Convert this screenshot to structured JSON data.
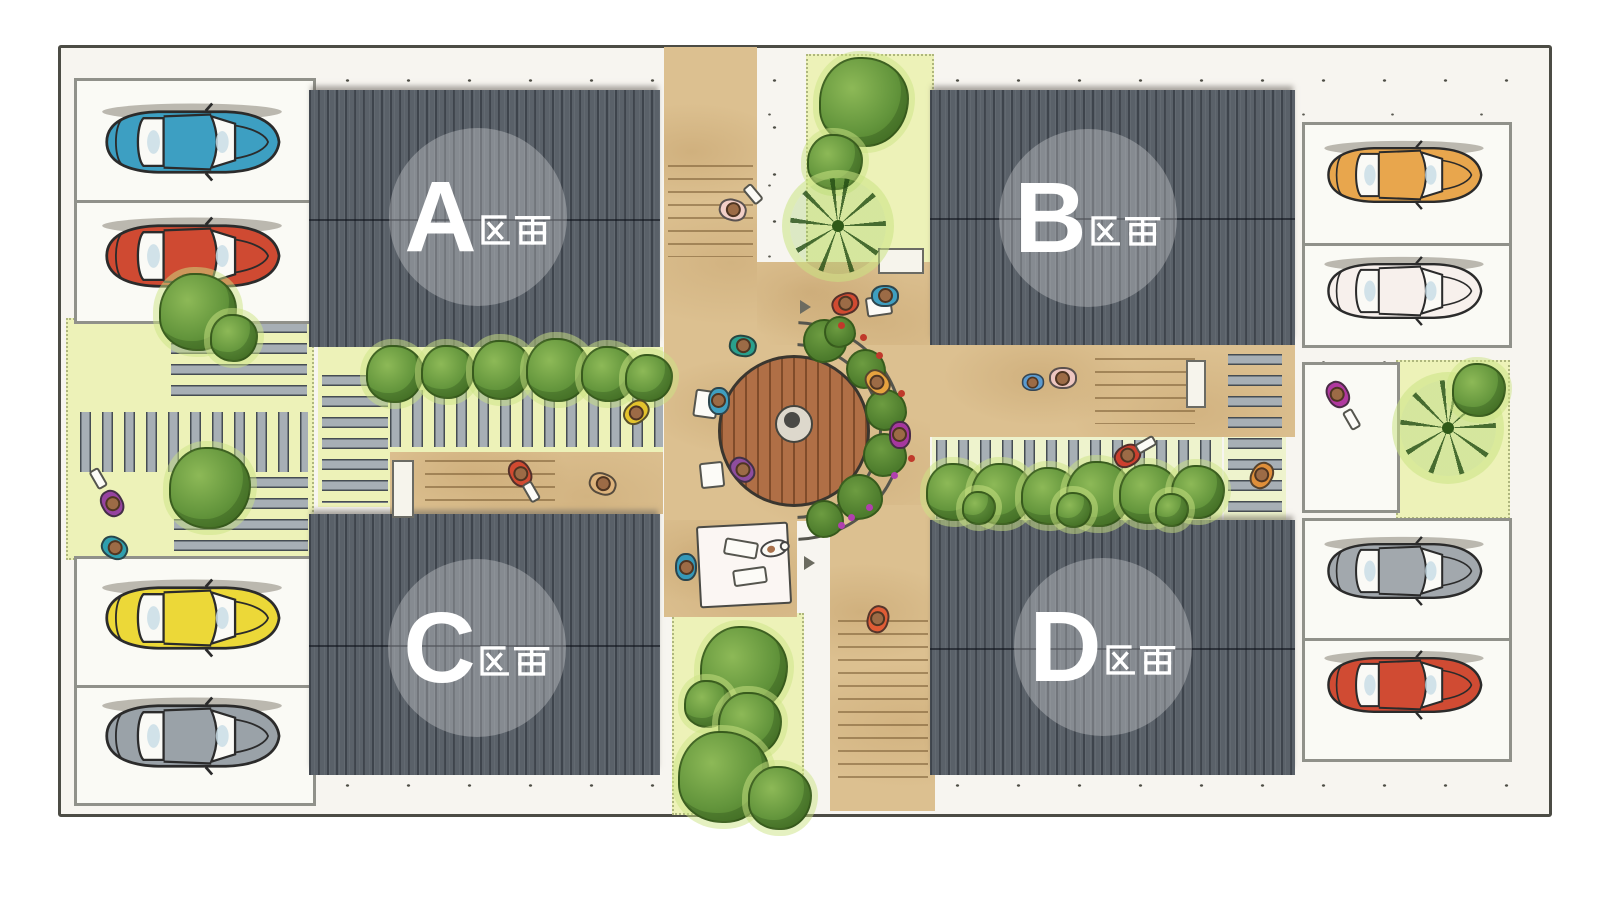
{
  "plan": {
    "title": "housing site plan",
    "plots": [
      {
        "letter": "A",
        "suffix": "区画"
      },
      {
        "letter": "B",
        "suffix": "区画"
      },
      {
        "letter": "C",
        "suffix": "区画"
      },
      {
        "letter": "D",
        "suffix": "区画"
      }
    ],
    "colors": {
      "roof": "#5a6169",
      "roof_ridge": "#343a43",
      "path_tan": "#dcc090",
      "grass": "#edf2b8",
      "stone": "#a7afb5",
      "stall_bg": "#fafaf5",
      "stall_border": "#90918a",
      "frame_bg": "#f7f5f0",
      "frame_border": "#4c4c45",
      "table_wood": "#b06f46",
      "label_circle": "rgba(255,255,255,0.27)"
    },
    "cars": [
      {
        "id": "car-top-left-1",
        "label": "teal car",
        "color": "#3d9fc2"
      },
      {
        "id": "car-top-left-2",
        "label": "red car",
        "color": "#cf4a32"
      },
      {
        "id": "car-bottom-left-1",
        "label": "yellow car",
        "color": "#ecd838"
      },
      {
        "id": "car-bottom-left-2",
        "label": "gray car",
        "color": "#9aa2a8"
      },
      {
        "id": "car-top-right-1",
        "label": "orange car",
        "color": "#e8a64d"
      },
      {
        "id": "car-top-right-2",
        "label": "white car",
        "color": "#f7f0ec"
      },
      {
        "id": "car-bottom-right-1",
        "label": "gray car",
        "color": "#a2a8ad"
      },
      {
        "id": "car-bottom-right-2",
        "label": "red car",
        "color": "#d04b33"
      }
    ],
    "people_colors": [
      "#f2cfc8",
      "#d14a31",
      "#3f9fc0",
      "#2aa08d",
      "#3f9fc0",
      "#8e4d9e",
      "#e7a33f",
      "#a6379e",
      "#5b9bd0",
      "#edc6c0",
      "#cc3f2e",
      "#df8f3a",
      "#b0399f",
      "#d14a31",
      "#ddb37c",
      "#e3c32c",
      "#9643a0",
      "#2f9fae",
      "#3598b8",
      "#e05c35"
    ],
    "flower_colors": [
      "#c0392b",
      "#b13fae"
    ]
  }
}
